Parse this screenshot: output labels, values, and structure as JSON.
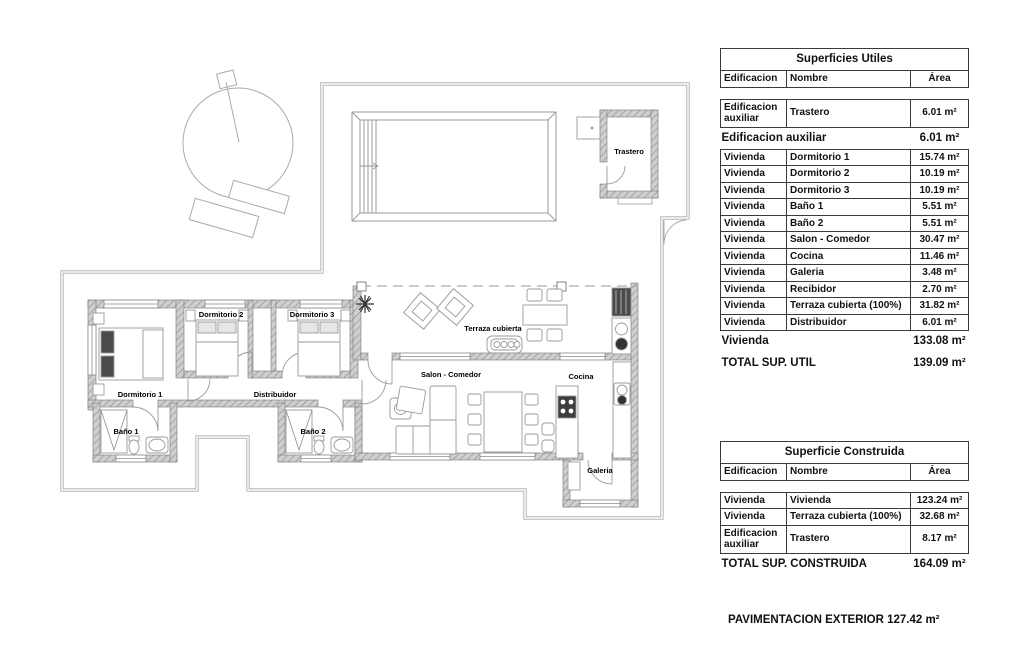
{
  "colors": {
    "wall_fill": "#cfcfcf",
    "wall_hatch": "#8f8f8f",
    "line": "#9a9a9a",
    "text": "#000000",
    "border": "#3a3a3a"
  },
  "plan": {
    "labels": {
      "trastero": "Trastero",
      "dormitorio1": "Dormitorio 1",
      "dormitorio2": "Dormitorio 2",
      "dormitorio3": "Dormitorio 3",
      "bano1": "Baño 1",
      "bano2": "Baño 2",
      "distribuidor": "Distribuidor",
      "salon": "Salon - Comedor",
      "cocina": "Cocina",
      "terraza": "Terraza cubierta",
      "galeria": "Galeria"
    }
  },
  "panel": {
    "utiles": {
      "title": "Superficies Utiles",
      "col_edificacion": "Edificacion",
      "col_nombre": "Nombre",
      "col_area": "Área",
      "rows": [
        {
          "e": "Edificacion auxiliar",
          "n": "Trastero",
          "a": "6.01 m²"
        },
        {
          "e": "Vivienda",
          "n": "Dormitorio 1",
          "a": "15.74 m²"
        },
        {
          "e": "Vivienda",
          "n": "Dormitorio 2",
          "a": "10.19 m²"
        },
        {
          "e": "Vivienda",
          "n": "Dormitorio 3",
          "a": "10.19 m²"
        },
        {
          "e": "Vivienda",
          "n": "Baño 1",
          "a": "5.51 m²"
        },
        {
          "e": "Vivienda",
          "n": "Baño 2",
          "a": "5.51 m²"
        },
        {
          "e": "Vivienda",
          "n": "Salon - Comedor",
          "a": "30.47 m²"
        },
        {
          "e": "Vivienda",
          "n": "Cocina",
          "a": "11.46 m²"
        },
        {
          "e": "Vivienda",
          "n": "Galeria",
          "a": "3.48 m²"
        },
        {
          "e": "Vivienda",
          "n": "Recibidor",
          "a": "2.70 m²"
        },
        {
          "e": "Vivienda",
          "n": "Terraza cubierta (100%)",
          "a": "31.82 m²"
        },
        {
          "e": "Vivienda",
          "n": "Distribuidor",
          "a": "6.01 m²"
        }
      ],
      "subtotal_aux": {
        "label": "Edificacion auxiliar",
        "value": "6.01 m²"
      },
      "subtotal_viv": {
        "label": "Vivienda",
        "value": "133.08 m²"
      },
      "total": {
        "label": "TOTAL SUP. UTIL",
        "value": "139.09 m²"
      }
    },
    "construida": {
      "title": "Superficie Construida",
      "col_edificacion": "Edificacion",
      "col_nombre": "Nombre",
      "col_area": "Área",
      "rows": [
        {
          "e": "Vivienda",
          "n": "Vivienda",
          "a": "123.24 m²"
        },
        {
          "e": "Vivienda",
          "n": "Terraza cubierta (100%)",
          "a": "32.68 m²"
        },
        {
          "e": "Edificacion auxiliar",
          "n": "Trastero",
          "a": "8.17 m²"
        }
      ],
      "total": {
        "label": "TOTAL SUP. CONSTRUIDA",
        "value": "164.09 m²"
      }
    },
    "footer": "PAVIMENTACION EXTERIOR 127.42 m²"
  }
}
